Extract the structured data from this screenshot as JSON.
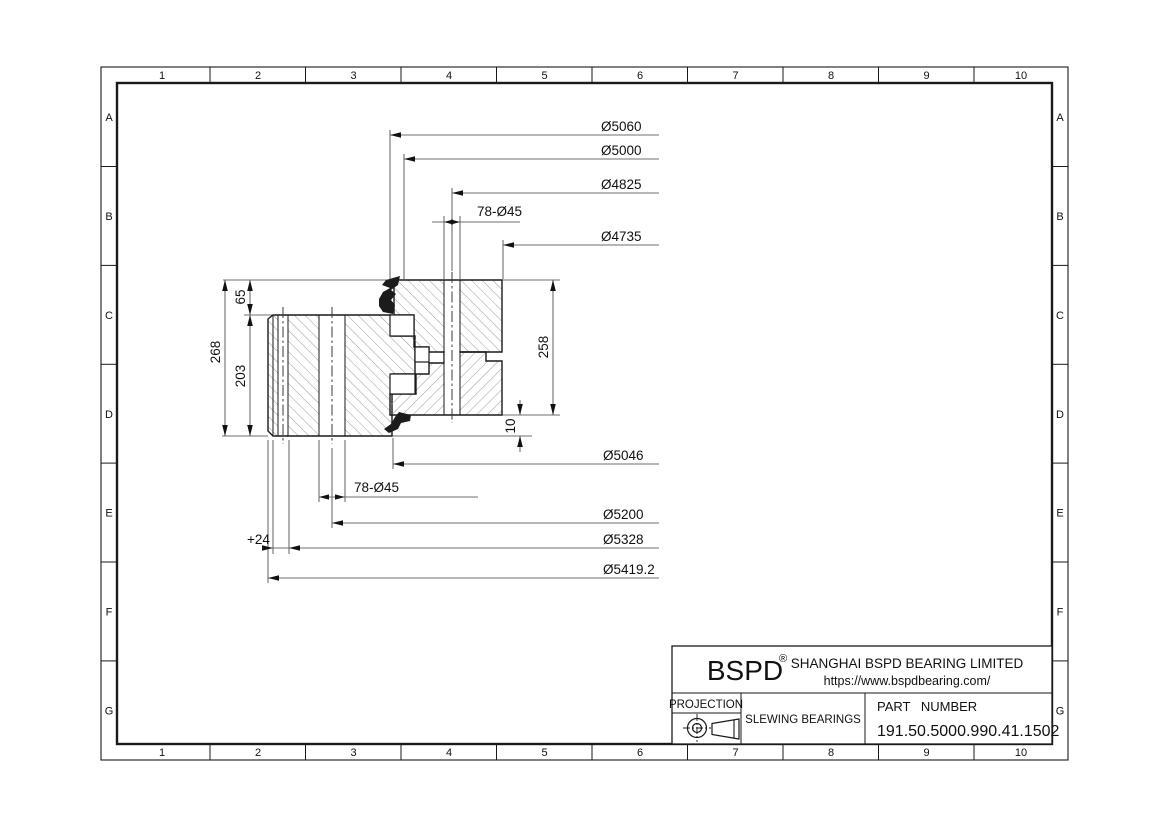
{
  "sheet": {
    "grid_columns": [
      "1",
      "2",
      "3",
      "4",
      "5",
      "6",
      "7",
      "8",
      "9",
      "10"
    ],
    "grid_rows": [
      "A",
      "B",
      "C",
      "D",
      "E",
      "F",
      "G"
    ]
  },
  "dimensions": {
    "d5060": "Ø5060",
    "d5000": "Ø5000",
    "d4825": "Ø4825",
    "bolt_top": "78-Ø45",
    "d4735": "Ø4735",
    "d5046": "Ø5046",
    "bolt_bottom": "78-Ø45",
    "d5200": "Ø5200",
    "d5328": "Ø5328",
    "d5419": "Ø5419.2",
    "plus24": "+24",
    "h268": "268",
    "h203": "203",
    "h65": "65",
    "h258": "258",
    "h10": "10"
  },
  "title_block": {
    "logo": "BSPD",
    "registered": "®",
    "company": "SHANGHAI BSPD BEARING LIMITED",
    "website": "https://www.bspdbearing.com/",
    "projection_label": "PROJECTION",
    "product_type": "SLEWING BEARINGS",
    "part_number_label": "PART NUMBER",
    "part_number": "191.50.5000.990.41.1502"
  },
  "colors": {
    "line": "#1a1a1a",
    "dim_line": "#6f6f6f",
    "hatch": "#8f8f8f",
    "background": "#ffffff"
  }
}
